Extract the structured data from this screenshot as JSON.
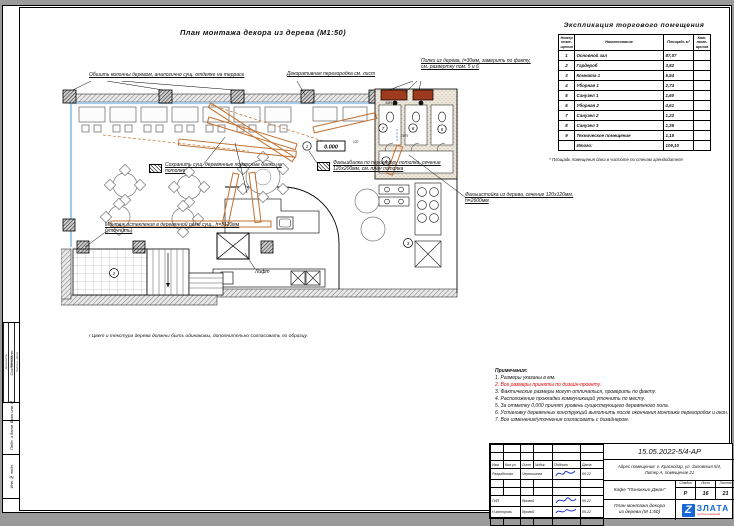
{
  "sheet": {
    "title": "План монтажа декора из дерева (М1:50)",
    "color_note": "! Цвет и текстура дерева должны быть одинаковы, дополнительно согласовать по образцу."
  },
  "plan": {
    "annotations": {
      "columns": "Обшить колонны деревом, аналогично сущ. отделке на террасе",
      "partition": "Декоративная перегородка см. лист",
      "shelves": "Полки из дерева, t=30мм, замерить по факту, см. развертку пом. 5 и 6",
      "beams": "Сохранить сущ. деревянные подвесные балки на потолке",
      "falsebeam": "Фальшбалка по периметру потолка, сечение 120х200мм, см. план потолка",
      "falsepost": "Фальшстойка из дерева, сечение 120х120мм, h=2600мм",
      "glazing": "Монтаж остекления в деревянной раме сущ., h=3120мм (уточнить)",
      "lift": "Лифт",
      "datum": "0.000"
    },
    "marks": [
      "1",
      "2",
      "3",
      "4",
      "5",
      "6",
      "7"
    ],
    "dimensions": [
      "2875",
      "3085",
      "120"
    ]
  },
  "explication": {
    "title": "Экспликация торгового помещения",
    "headers": [
      "Номер поме- щения",
      "Наименование",
      "Площадь м²",
      "Кат. поме- щения"
    ],
    "rows": [
      {
        "num": "1",
        "name": "Основной зал",
        "area": "87,07"
      },
      {
        "num": "2",
        "name": "Гардероб",
        "area": "3,82"
      },
      {
        "num": "3",
        "name": "Комната 1",
        "area": "5,54"
      },
      {
        "num": "4",
        "name": "Уборная 1",
        "area": "2,74"
      },
      {
        "num": "5",
        "name": "Санузел 1",
        "area": "1,60"
      },
      {
        "num": "6",
        "name": "Уборная 2",
        "area": "4,61"
      },
      {
        "num": "7",
        "name": "Санузел 2",
        "area": "1,22"
      },
      {
        "num": "8",
        "name": "Санузел 3",
        "area": "1,35"
      },
      {
        "num": "9",
        "name": "Техническое помещение",
        "area": "1,15"
      }
    ],
    "total_label": "Итого:",
    "total_value": "109,10",
    "footnote": "* Площадь помещения дана в чистоте по стенам арендодателя"
  },
  "notes": {
    "title": "Примечания:",
    "items": [
      "1. Размеры указаны в мм.",
      "2. Все размеры приняты по дизайн-проекту.",
      "3. Фактические размеры могут отличаться, проверить по факту.",
      "4. Расположение прокладки коммуникаций уточнить по месту.",
      "5. За отметку 0,000 принят уровень существующего деревянного пола.",
      "6. Установку деревянных конструкций выполнить после окончания монтажа перегородок и окон.",
      "7. Все изменения/уточнения согласовать с дизайнером."
    ]
  },
  "titleblock": {
    "doc_number": "15.05.2022-5/4-АР",
    "address_l1": "Адрес помещения: г. Краснодар, ул. Зиповская 5/4,",
    "address_l2": "Литер А, помещение 21",
    "project": "Кафе \"Пиноккио Джан\"",
    "stage_label": "Стадия",
    "sheet_label": "Лист",
    "sheets_label": "Листов",
    "stage": "Р",
    "sheet_no": "16",
    "sheets_total": "21",
    "drawing_l1": "План монтажа декора",
    "drawing_l2": "из дерева (М 1:50)",
    "logo_letter": "Z",
    "logo_text": "ЗЛАТА",
    "logo_sub": "группа компаний",
    "sig_header": [
      "Изм.",
      "Кол.уч",
      "Лист",
      "№док.",
      "Подпись",
      "Дата"
    ],
    "sig_rows": [
      {
        "role": "Разработал",
        "name": "Чернышева",
        "date": "05.22"
      },
      {
        "role": "ГИП",
        "name": "Яровой",
        "date": "05.22"
      },
      {
        "role": "Н.контроль",
        "name": "Яровой",
        "date": "05.22"
      }
    ]
  },
  "side_stamps": {
    "agreed": "Согласовано:",
    "cols": [
      "Должность",
      "Фамилия",
      "Подпись, Дата"
    ],
    "vzam": "Взам.инв.№",
    "podp": "Подп. и дата",
    "inv": "Инв.№ подл."
  }
}
